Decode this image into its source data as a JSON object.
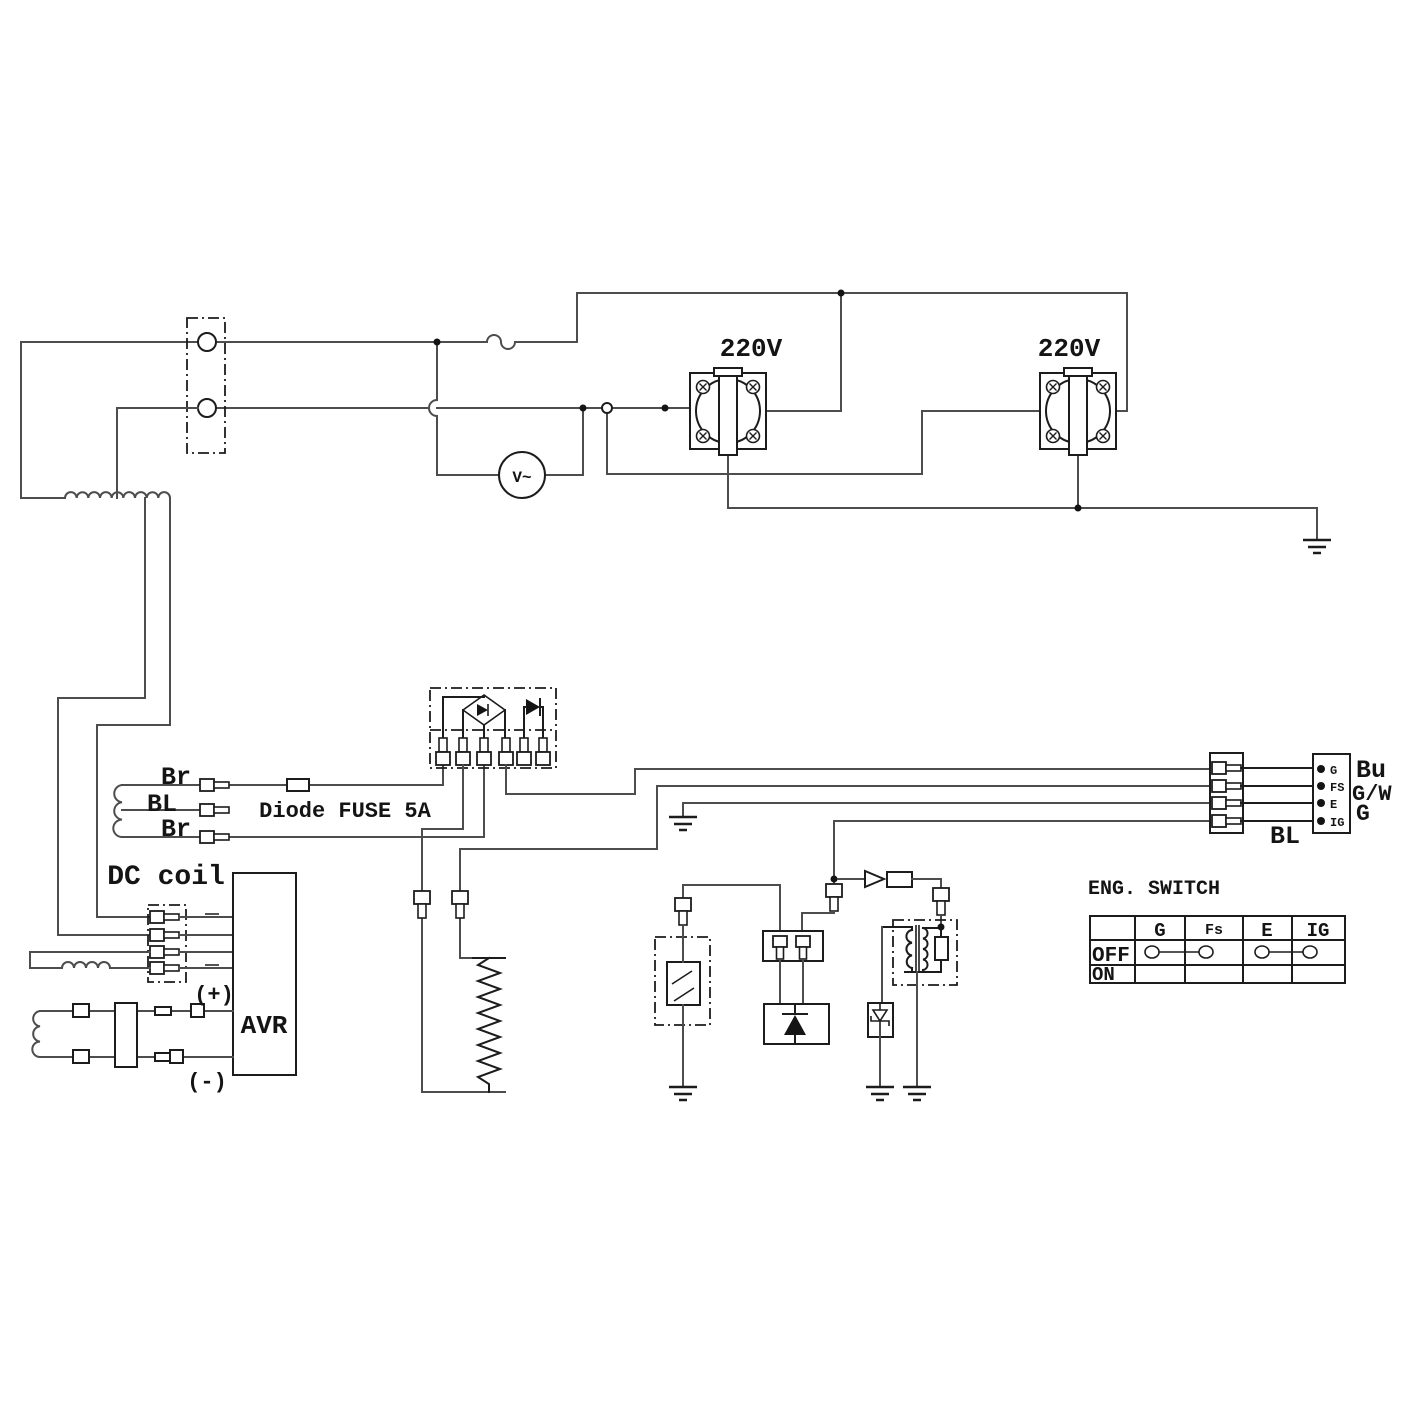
{
  "labels": {
    "outlet1": "220V",
    "outlet2": "220V",
    "voltmeter": "V~",
    "br_top": "Br",
    "bl": "BL",
    "br_bottom": "Br",
    "fuse": "Diode FUSE 5A",
    "dc_coil": "DC coil",
    "avr": "AVR",
    "plus": "(+)",
    "minus": "(-)",
    "bl_wire": "BL"
  },
  "connector": {
    "pins": [
      "G",
      "FS",
      "E",
      "IG"
    ],
    "wires": [
      "Bu",
      "G/W",
      "G"
    ]
  },
  "eng_switch": {
    "title": "ENG. SWITCH",
    "columns": [
      "G",
      "Fs",
      "E",
      "IG"
    ],
    "rows": [
      "OFF",
      "ON"
    ],
    "off_connections": [
      [
        "G",
        "Fs"
      ],
      [
        "E",
        "IG"
      ]
    ]
  }
}
